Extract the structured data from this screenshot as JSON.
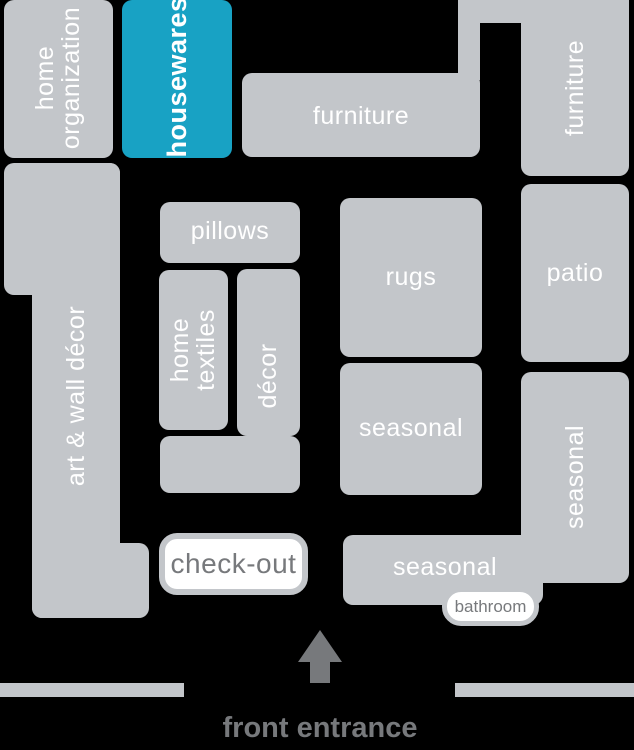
{
  "colors": {
    "bg": "#000000",
    "box": "#c3c6ca",
    "highlight": "#18a2c4",
    "text": "#ffffff",
    "muted": "#77797c"
  },
  "highlighted_department": "housewares",
  "labels": {
    "home_organization": "home organization",
    "housewares": "housewares",
    "furniture_main": "furniture",
    "furniture_right": "furniture",
    "art_wall_decor": "art & wall décor",
    "pillows": "pillows",
    "home_textiles": "home textiles",
    "decor": "décor",
    "rugs": "rugs",
    "patio": "patio",
    "seasonal_mid": "seasonal",
    "seasonal_right": "seasonal",
    "seasonal_bottom": "seasonal",
    "check_out": "check-out",
    "bathroom": "bathroom",
    "front_entrance": "front entrance"
  }
}
